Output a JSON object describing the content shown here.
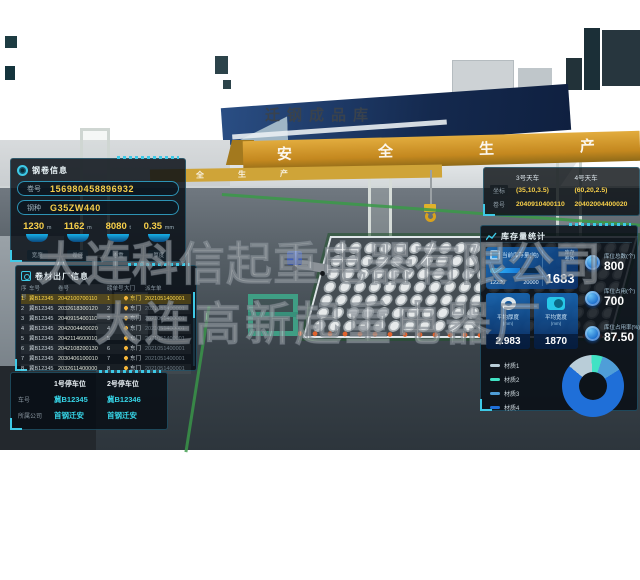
{
  "scene": {
    "building_title": "迁钢成品库",
    "crane_banner": "安全生产",
    "crane_banner_secondary": "全生产"
  },
  "watermark": {
    "line1": "大连科信起重电器有限公司",
    "line2": "大连高新起重电器厂"
  },
  "coil_info": {
    "title": "钢卷信息",
    "fields": [
      {
        "label": "卷号",
        "value": "156980458896932"
      },
      {
        "label": "钢种",
        "value": "G35ZW440"
      }
    ],
    "stats": [
      {
        "value": "1230",
        "unit": "m",
        "label": "宽度"
      },
      {
        "value": "1162",
        "unit": "m",
        "label": "卷径"
      },
      {
        "value": "8080",
        "unit": "t",
        "label": "卷重"
      },
      {
        "value": "0.35",
        "unit": "mm",
        "label": "厚度"
      }
    ]
  },
  "shipment": {
    "title": "卷材出厂信息",
    "columns": [
      "序号",
      "车号",
      "卷号",
      "磅单号",
      "大门",
      "派车单"
    ],
    "rows": [
      {
        "no": "1",
        "truck": "冀B12345",
        "coil": "2042100700110",
        "ticket": "1",
        "gate": "东门",
        "dispatch": "2021051400001",
        "highlight": true
      },
      {
        "no": "2",
        "truck": "冀B12345",
        "coil": "2032618300120",
        "ticket": "2",
        "gate": "东门",
        "dispatch": "2021051400001"
      },
      {
        "no": "3",
        "truck": "冀B12345",
        "coil": "2040915400110",
        "ticket": "3",
        "gate": "东门",
        "dispatch": "2021051400001"
      },
      {
        "no": "4",
        "truck": "冀B12345",
        "coil": "2042004400020",
        "ticket": "4",
        "gate": "东门",
        "dispatch": "2021051400001"
      },
      {
        "no": "5",
        "truck": "冀B12345",
        "coil": "2042114600010",
        "ticket": "5",
        "gate": "东门",
        "dispatch": "2021051400001"
      },
      {
        "no": "6",
        "truck": "冀B12345",
        "coil": "2042108200130",
        "ticket": "6",
        "gate": "东门",
        "dispatch": "2021051400001"
      },
      {
        "no": "7",
        "truck": "冀B12345",
        "coil": "2030406100010",
        "ticket": "7",
        "gate": "东门",
        "dispatch": "2021051400001"
      },
      {
        "no": "8",
        "truck": "冀B12345",
        "coil": "2032611400000",
        "ticket": "8",
        "gate": "东门",
        "dispatch": "2021051400001"
      }
    ]
  },
  "parking": {
    "labels": {
      "plate": "车号",
      "company": "所属公司"
    },
    "spots": [
      {
        "title": "1号停车位",
        "plate": "冀B12345",
        "company": "首钢迁安"
      },
      {
        "title": "2号停车位",
        "plate": "冀B12346",
        "company": "首钢迁安"
      }
    ]
  },
  "cranes": {
    "row_labels": {
      "coord": "坐标",
      "coil": "卷号"
    },
    "items": [
      {
        "name": "3号天车",
        "coord": "(35,10,3.5)",
        "coil": "2040910400110"
      },
      {
        "name": "4号天车",
        "coord": "(60,20,2.5)",
        "coil": "20402004400020"
      }
    ]
  },
  "inventory": {
    "title": "库存量统计",
    "stock_card": {
      "label": "当前库存量(吨)",
      "current": "12230",
      "max": "20000",
      "side_label_1": "库存",
      "side_label_2": "卷数",
      "count": "1683"
    },
    "avg_cards": [
      {
        "label": "平均厚度",
        "unit": "(mm)",
        "value": "2.983"
      },
      {
        "label": "平均宽度",
        "unit": "(mm)",
        "value": "1870"
      }
    ],
    "slots": [
      {
        "label": "库位总数(个)",
        "value": "800"
      },
      {
        "label": "库位占用(个)",
        "value": "700"
      },
      {
        "label": "库位占用率(%)",
        "value": "87.50"
      }
    ]
  },
  "chart_data": {
    "type": "pie",
    "donut": true,
    "categories": [
      "材质1",
      "材质2",
      "材质3",
      "材质4"
    ],
    "values": [
      13,
      6,
      11,
      70
    ],
    "colors": [
      "#b9cdd8",
      "#41e2c4",
      "#4f9ed8",
      "#1f6fd8"
    ],
    "legend_position": "left",
    "start_angle_deg": -50
  }
}
